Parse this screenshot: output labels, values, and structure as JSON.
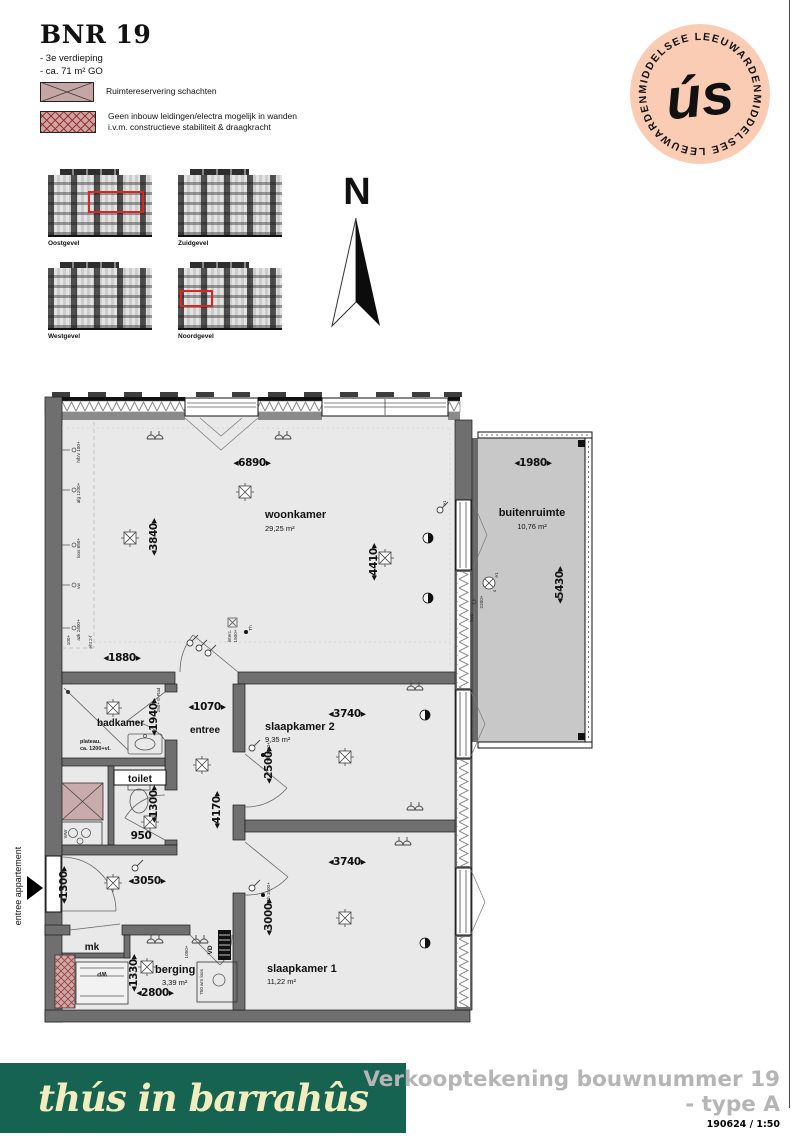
{
  "header": {
    "title": "BNR 19",
    "line1": "- 3e verdieping",
    "line2": "- ca. 71 m² GO"
  },
  "legend": {
    "item1": "Ruimtereservering schachten",
    "item2_line1": "Geen inbouw leidingen/electra mogelijk in wanden",
    "item2_line2": "i.v.m. constructieve stabiliteit & draagkracht"
  },
  "logo": {
    "script": "ús",
    "ring_top": "MIDDELSEE  LEEUWARDEN",
    "ring_bottom": "MIDDELSEE  LEEUWARDEN"
  },
  "north_label": "N",
  "elevations": {
    "labels": [
      "Oostgevel",
      "Zuidgevel",
      "Westgevel",
      "Noordgevel"
    ]
  },
  "plan": {
    "rooms": {
      "woonkamer": {
        "name": "woonkamer",
        "area": "29,25 m²"
      },
      "buitenruimte": {
        "name": "buitenruimte",
        "area": "10,76 m²"
      },
      "badkamer": {
        "name": "badkamer"
      },
      "toilet": {
        "name": "toilet"
      },
      "slaapkamer2": {
        "name": "slaapkamer 2",
        "area": "9,35 m²"
      },
      "slaapkamer1": {
        "name": "slaapkamer 1",
        "area": "11,22 m²"
      },
      "berging": {
        "name": "berging",
        "area": "3,39 m²"
      },
      "entree": {
        "name": "entree"
      },
      "mk": {
        "name": "mk"
      }
    },
    "dims": {
      "d6890": "◂6890▸",
      "d3840": "◂3840▸",
      "d4410": "◂4410▸",
      "d1980": "◂1980▸",
      "d5430": "◂5430▸",
      "d1880": "◂1880▸",
      "d1940": "◂1940▸",
      "d1070": "◂1070▸",
      "d3740a": "◂3740▸",
      "d2500": "◂2500▸",
      "d4170": "◂4170▸",
      "d1300a": "◂1300▸",
      "d950": "950",
      "d1300b": "◂1300▸",
      "d3050": "◂3050▸",
      "d1330": "◂1330▸",
      "d2800": "◂2800▸",
      "d3740b": "◂3740▸",
      "d3000": "◂3000▸"
    },
    "ann": {
      "entree_app": "entree appartement",
      "plateau1": "plateau,",
      "plateau2": "ca. 1200+vl.",
      "hwa": "hwa",
      "h2200": "2200+",
      "e1": "e1",
      "s": "s",
      "th": "Th",
      "th1500": "Th 1500+",
      "interc": "interc.",
      "i1500": "1500+",
      "erad": "250+ E-Rad",
      "vd": "VD",
      "wp": "WP",
      "ww": "WW",
      "wm": "750 wm loos",
      "b1050": "1050+",
      "eht": "eht 2-f",
      "h100": "100+"
    },
    "kitchen_labels": [
      "h/b'v 100+",
      "afg 1200+",
      "loos 650+",
      "vw",
      "azk 2400+"
    ]
  },
  "footer": {
    "brand": "thús in barrahûs",
    "line1": "Verkooptekening bouwnummer 19",
    "line2": "- type A",
    "meta": "190624 /  1:50"
  },
  "colors": {
    "logo_pink": "#e8537a",
    "logo_bg": "#f9ccb3",
    "footer_green": "#156350",
    "shaft_fill": "#c9abab",
    "hatch_red": "#b03a3a",
    "cream": "#f2edbe",
    "muted_gray": "#b5b5b5"
  }
}
